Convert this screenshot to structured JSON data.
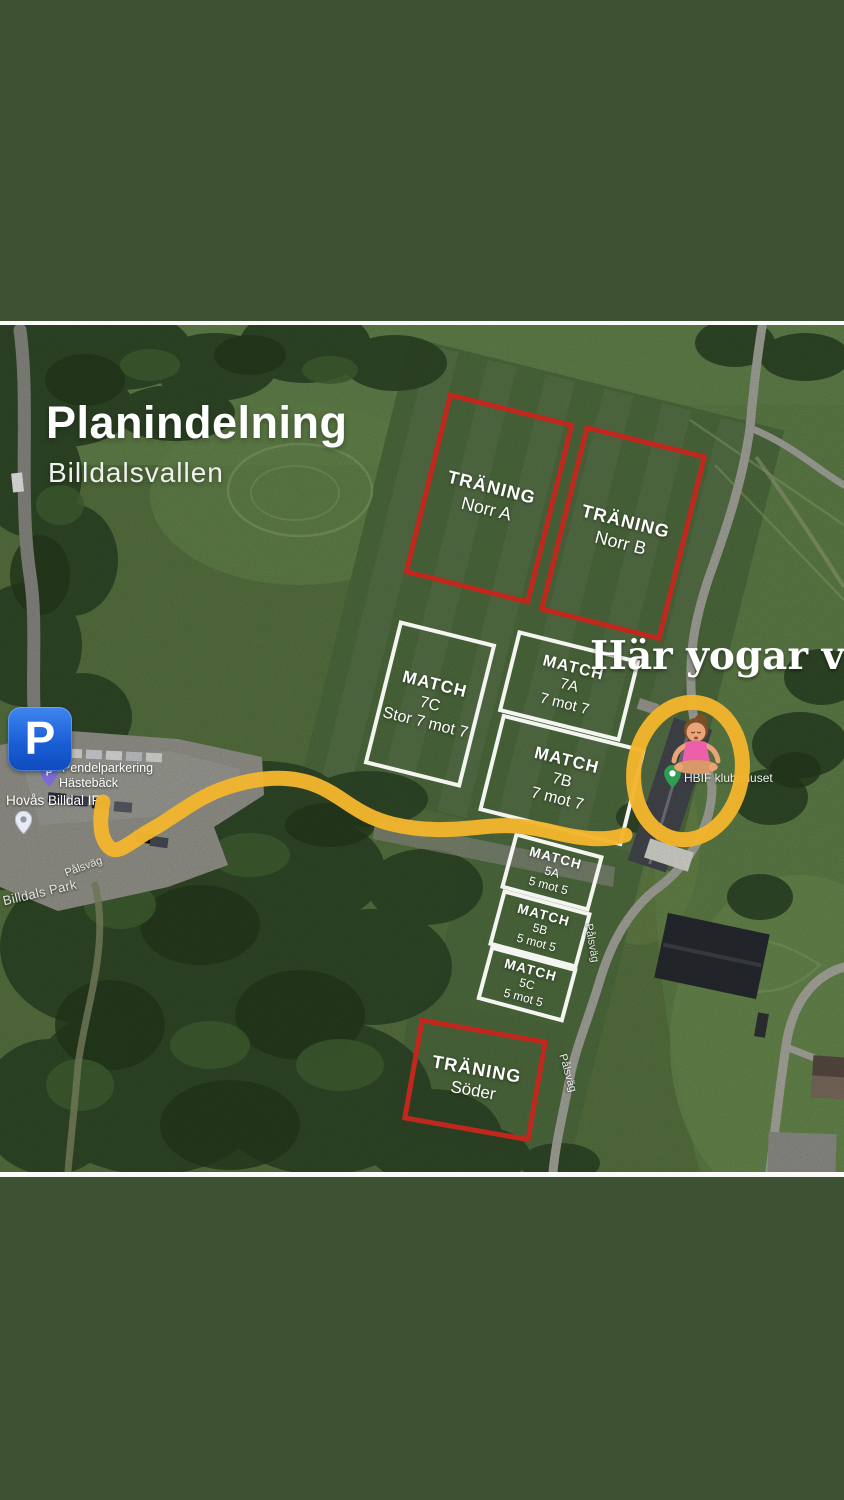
{
  "story": {
    "frame_color": "#3d5233"
  },
  "map": {
    "title": "Planindelning",
    "subtitle": "Billdalsvallen",
    "annotation": "Här yogar vi",
    "fields": [
      {
        "id": "traning-norr-a",
        "type": "TRÄNING",
        "code": "Norr A",
        "detail": "",
        "outline": "red"
      },
      {
        "id": "traning-norr-b",
        "type": "TRÄNING",
        "code": "Norr B",
        "detail": "",
        "outline": "red"
      },
      {
        "id": "match-7c",
        "type": "MATCH",
        "code": "7C",
        "detail": "Stor 7 mot 7",
        "outline": "white"
      },
      {
        "id": "match-7a",
        "type": "MATCH",
        "code": "7A",
        "detail": "7 mot 7",
        "outline": "white"
      },
      {
        "id": "match-7b",
        "type": "MATCH",
        "code": "7B",
        "detail": "7 mot 7",
        "outline": "white"
      },
      {
        "id": "match-5a",
        "type": "MATCH",
        "code": "5A",
        "detail": "5 mot 5",
        "outline": "white"
      },
      {
        "id": "match-5b",
        "type": "MATCH",
        "code": "5B",
        "detail": "5 mot 5",
        "outline": "white"
      },
      {
        "id": "match-5c",
        "type": "MATCH",
        "code": "5C",
        "detail": "5 mot 5",
        "outline": "white"
      },
      {
        "id": "traning-soder",
        "type": "TRÄNING",
        "code": "Söder",
        "detail": "",
        "outline": "red"
      }
    ],
    "labels": {
      "parking_symbol": "P",
      "parking_line1": "Pendelparkering",
      "parking_line2": "Hästebäck",
      "club_name": "Hovås Billdal IF",
      "park_name": "Billdals Park",
      "clubhouse_name": "HBIF klubbhuset",
      "road_name": "Pålsväg"
    },
    "colors": {
      "field_outline_red": "#c1281d",
      "field_outline_white": "#f4f5f1",
      "route_yellow": "#f2b52d",
      "parking_blue": "#1b6be0",
      "pin_green": "#2f9e52",
      "frame_green": "#3d5233"
    }
  }
}
